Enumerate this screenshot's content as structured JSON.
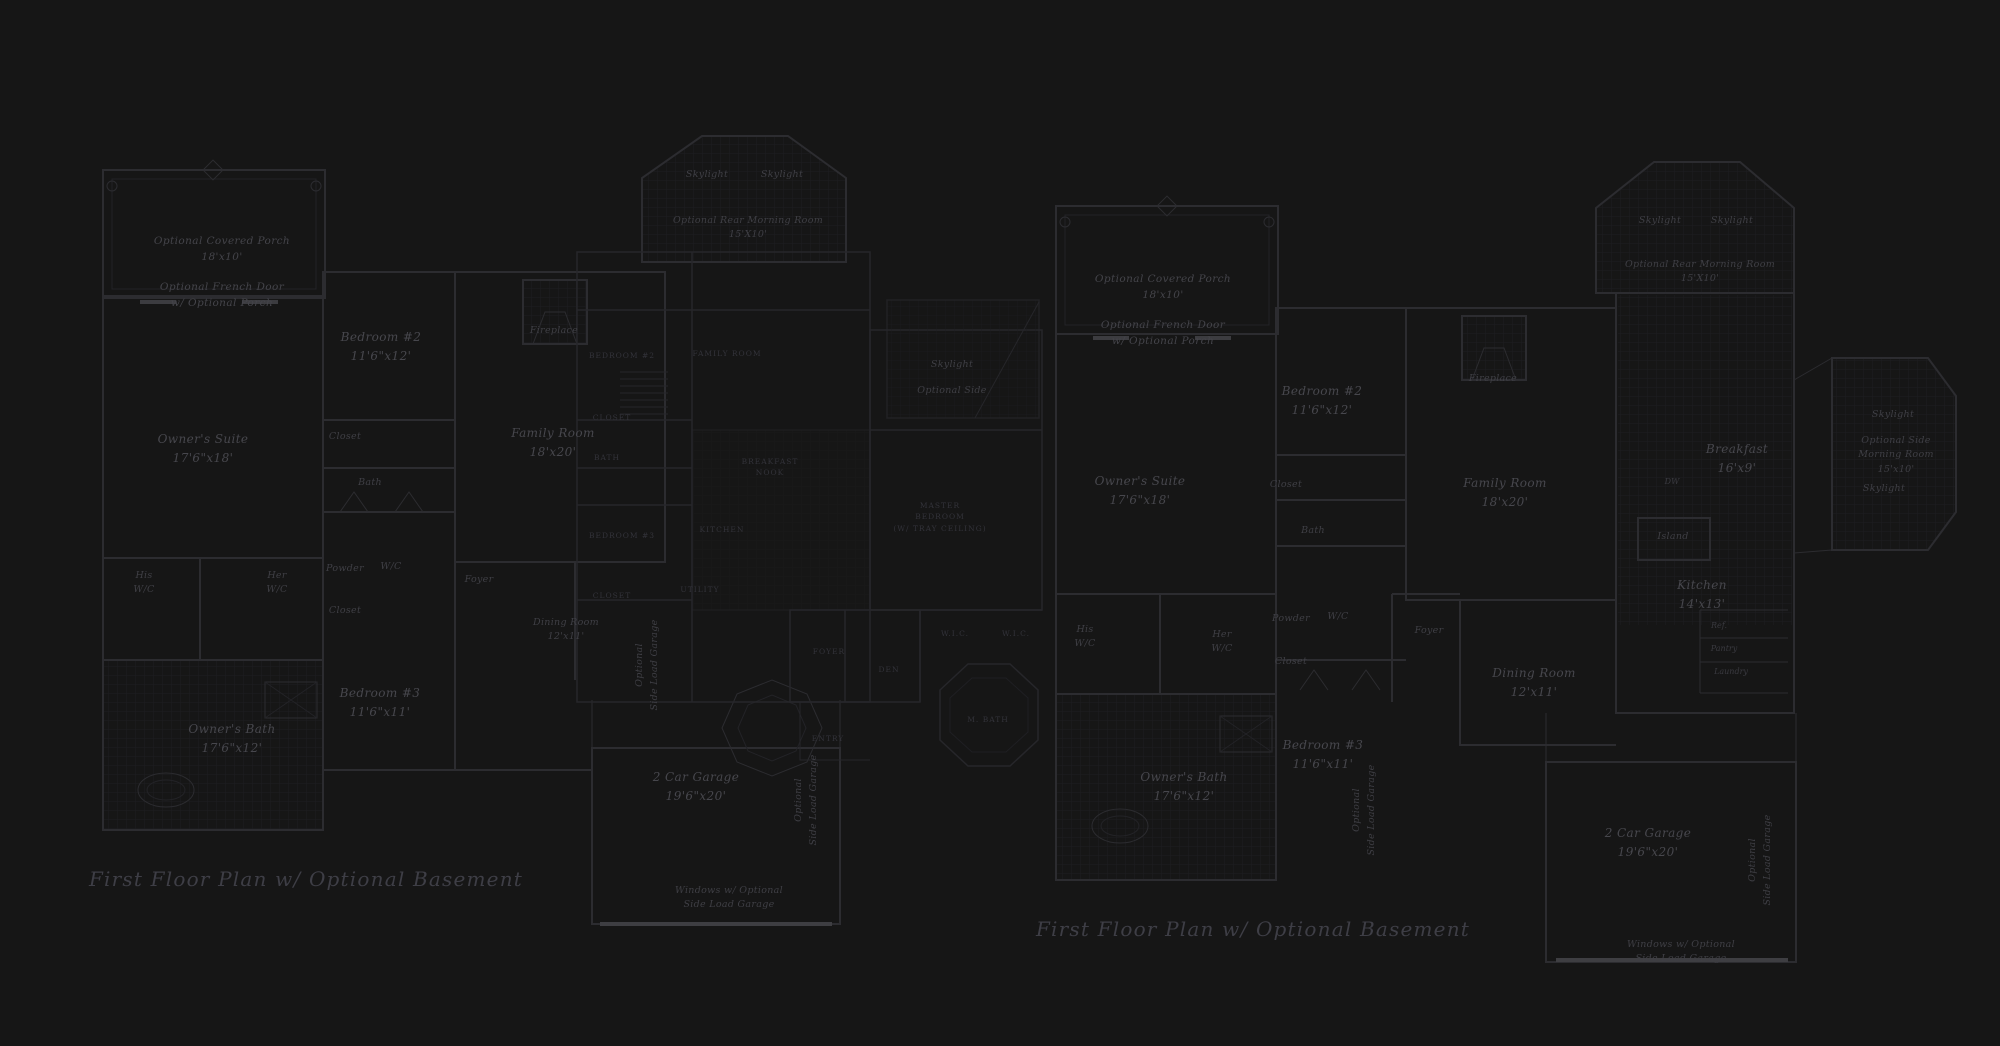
{
  "document": {
    "kind": "architectural floor plan sheet",
    "background": "#161616"
  },
  "colors": {
    "background": "#161616",
    "wall": "#2c2c30",
    "wall_faint": "#26262a",
    "wall_bright": "#3e3e42",
    "tile_grid": "#1e1e21",
    "script_text": "#44444a",
    "caps_text": "#33333a",
    "title_text": "#3e3e46"
  },
  "plan_titles": {
    "left": "First Floor Plan  w/ Optional Basement",
    "right": "First Floor Plan  w/ Optional Basement"
  },
  "labels": [
    {
      "n": "porch-label-left",
      "x": 222,
      "y": 234,
      "c": "s",
      "t": [
        "Optional Covered Porch",
        "18'x10'"
      ]
    },
    {
      "n": "french-door-left",
      "x": 222,
      "y": 280,
      "c": "s",
      "t": [
        "Optional French Door",
        "w/ Optional Porch"
      ]
    },
    {
      "n": "owners-suite-left",
      "x": 203,
      "y": 430,
      "c": "m",
      "t": [
        "Owner's Suite",
        "17'6\"x18'"
      ]
    },
    {
      "n": "bedroom2-left",
      "x": 381,
      "y": 328,
      "c": "m",
      "t": [
        "Bedroom #2",
        "11'6\"x12'"
      ]
    },
    {
      "n": "closet-upper-left",
      "x": 345,
      "y": 430,
      "c": "sm",
      "t": [
        "Closet"
      ]
    },
    {
      "n": "bath-left",
      "x": 370,
      "y": 476,
      "c": "sm",
      "t": [
        "Bath"
      ]
    },
    {
      "n": "fireplace-left",
      "x": 554,
      "y": 324,
      "c": "sm",
      "t": [
        "Fireplace"
      ]
    },
    {
      "n": "family-room-left",
      "x": 553,
      "y": 424,
      "c": "m",
      "t": [
        "Family Room",
        "18'x20'"
      ]
    },
    {
      "n": "skylight-left-a",
      "x": 707,
      "y": 168,
      "c": "sm",
      "t": [
        "Skylight"
      ]
    },
    {
      "n": "skylight-left-b",
      "x": 782,
      "y": 168,
      "c": "sm",
      "t": [
        "Skylight"
      ]
    },
    {
      "n": "rear-morning-room-left",
      "x": 748,
      "y": 214,
      "c": "sm",
      "t": [
        "Optional Rear Morning Room",
        "15'X10'"
      ]
    },
    {
      "n": "foyer-left",
      "x": 479,
      "y": 573,
      "c": "sm",
      "t": [
        "Foyer"
      ]
    },
    {
      "n": "dining-room-left",
      "x": 566,
      "y": 616,
      "c": "sm",
      "t": [
        "Dining Room",
        "12'x11'"
      ]
    },
    {
      "n": "his-wc-left",
      "x": 144,
      "y": 569,
      "c": "sm",
      "t": [
        "His",
        "W/C"
      ]
    },
    {
      "n": "her-wc-left",
      "x": 277,
      "y": 569,
      "c": "sm",
      "t": [
        "Her",
        "W/C"
      ]
    },
    {
      "n": "powder-left",
      "x": 345,
      "y": 562,
      "c": "sm",
      "t": [
        "Powder"
      ]
    },
    {
      "n": "wc-left",
      "x": 391,
      "y": 560,
      "c": "sm",
      "t": [
        "W/C"
      ]
    },
    {
      "n": "closet-lower-left",
      "x": 345,
      "y": 604,
      "c": "sm",
      "t": [
        "Closet"
      ]
    },
    {
      "n": "bedroom3-left",
      "x": 380,
      "y": 684,
      "c": "m",
      "t": [
        "Bedroom #3",
        "11'6\"x11'"
      ]
    },
    {
      "n": "owners-bath-left",
      "x": 232,
      "y": 720,
      "c": "m",
      "t": [
        "Owner's Bath",
        "17'6\"x12'"
      ]
    },
    {
      "n": "garage-left",
      "x": 696,
      "y": 768,
      "c": "m",
      "t": [
        "2 Car Garage",
        "19'6\"x20'"
      ]
    },
    {
      "n": "side-load-vert-left-a",
      "x": 647,
      "y": 665,
      "c": "vert",
      "t": [
        "Optional",
        "Side Load Garage"
      ]
    },
    {
      "n": "side-load-vert-left-b",
      "x": 806,
      "y": 800,
      "c": "vert",
      "t": [
        "Optional",
        "Side Load Garage"
      ]
    },
    {
      "n": "windows-note-left",
      "x": 729,
      "y": 884,
      "c": "sm",
      "t": [
        "Windows w/ Optional",
        "Side Load Garage"
      ]
    },
    {
      "n": "title-left",
      "x": 306,
      "y": 866,
      "c": "title",
      "t": [
        "First Floor Plan  w/ Optional Basement"
      ]
    },
    {
      "n": "mid-bedroom2",
      "x": 622,
      "y": 350,
      "c": "caps",
      "t": [
        "BEDROOM #2"
      ]
    },
    {
      "n": "mid-family-room",
      "x": 727,
      "y": 348,
      "c": "caps",
      "t": [
        "FAMILY ROOM"
      ]
    },
    {
      "n": "mid-closet-a",
      "x": 612,
      "y": 412,
      "c": "caps",
      "t": [
        "CLOSET"
      ]
    },
    {
      "n": "mid-bath",
      "x": 607,
      "y": 452,
      "c": "caps",
      "t": [
        "BATH"
      ]
    },
    {
      "n": "mid-bedroom3",
      "x": 622,
      "y": 530,
      "c": "caps",
      "t": [
        "BEDROOM #3"
      ]
    },
    {
      "n": "mid-breakfast-nook",
      "x": 770,
      "y": 456,
      "c": "caps",
      "t": [
        "BREAKFAST",
        "NOOK"
      ]
    },
    {
      "n": "mid-kitchen",
      "x": 722,
      "y": 524,
      "c": "caps",
      "t": [
        "KITCHEN"
      ]
    },
    {
      "n": "mid-utility",
      "x": 700,
      "y": 584,
      "c": "caps",
      "t": [
        "UTILITY"
      ]
    },
    {
      "n": "mid-closet-b",
      "x": 612,
      "y": 590,
      "c": "caps",
      "t": [
        "CLOSET"
      ]
    },
    {
      "n": "mid-skylight",
      "x": 952,
      "y": 358,
      "c": "sm",
      "t": [
        "Skylight"
      ]
    },
    {
      "n": "mid-optional-side",
      "x": 952,
      "y": 384,
      "c": "sm",
      "t": [
        "Optional Side"
      ]
    },
    {
      "n": "mid-master-bedroom",
      "x": 940,
      "y": 500,
      "c": "caps",
      "t": [
        "MASTER",
        "BEDROOM",
        "(W/ TRAY CEILING)"
      ]
    },
    {
      "n": "mid-wic-a",
      "x": 955,
      "y": 628,
      "c": "caps",
      "t": [
        "W.I.C."
      ]
    },
    {
      "n": "mid-wic-b",
      "x": 1016,
      "y": 628,
      "c": "caps",
      "t": [
        "W.I.C."
      ]
    },
    {
      "n": "mid-mbath",
      "x": 988,
      "y": 714,
      "c": "caps",
      "t": [
        "M. BATH"
      ]
    },
    {
      "n": "mid-foyer",
      "x": 829,
      "y": 646,
      "c": "caps",
      "t": [
        "FOYER"
      ]
    },
    {
      "n": "mid-den",
      "x": 889,
      "y": 664,
      "c": "caps",
      "t": [
        "DEN"
      ]
    },
    {
      "n": "mid-entry",
      "x": 828,
      "y": 733,
      "c": "caps",
      "t": [
        "ENTRY"
      ]
    },
    {
      "n": "porch-label-right",
      "x": 1163,
      "y": 272,
      "c": "s",
      "t": [
        "Optional Covered Porch",
        "18'x10'"
      ]
    },
    {
      "n": "french-door-right",
      "x": 1163,
      "y": 318,
      "c": "s",
      "t": [
        "Optional French Door",
        "w/ Optional Porch"
      ]
    },
    {
      "n": "owners-suite-right",
      "x": 1140,
      "y": 472,
      "c": "m",
      "t": [
        "Owner's Suite",
        "17'6\"x18'"
      ]
    },
    {
      "n": "bedroom2-right",
      "x": 1322,
      "y": 382,
      "c": "m",
      "t": [
        "Bedroom #2",
        "11'6\"x12'"
      ]
    },
    {
      "n": "closet-upper-right",
      "x": 1286,
      "y": 478,
      "c": "sm",
      "t": [
        "Closet"
      ]
    },
    {
      "n": "bath-right",
      "x": 1313,
      "y": 524,
      "c": "sm",
      "t": [
        "Bath"
      ]
    },
    {
      "n": "fireplace-right",
      "x": 1493,
      "y": 372,
      "c": "sm",
      "t": [
        "Fireplace"
      ]
    },
    {
      "n": "family-room-right",
      "x": 1505,
      "y": 474,
      "c": "m",
      "t": [
        "Family Room",
        "18'x20'"
      ]
    },
    {
      "n": "skylight-right-a",
      "x": 1660,
      "y": 214,
      "c": "sm",
      "t": [
        "Skylight"
      ]
    },
    {
      "n": "skylight-right-b",
      "x": 1732,
      "y": 214,
      "c": "sm",
      "t": [
        "Skylight"
      ]
    },
    {
      "n": "rear-morning-room-right",
      "x": 1700,
      "y": 258,
      "c": "sm",
      "t": [
        "Optional Rear Morning Room",
        "15'X10'"
      ]
    },
    {
      "n": "breakfast-right",
      "x": 1737,
      "y": 440,
      "c": "m",
      "t": [
        "Breakfast",
        "16'x9'"
      ]
    },
    {
      "n": "dw-right",
      "x": 1672,
      "y": 476,
      "c": "xs",
      "t": [
        "DW"
      ]
    },
    {
      "n": "island-right",
      "x": 1673,
      "y": 530,
      "c": "sm",
      "t": [
        "Island"
      ]
    },
    {
      "n": "kitchen-right",
      "x": 1702,
      "y": 576,
      "c": "m",
      "t": [
        "Kitchen",
        "14'x13'"
      ]
    },
    {
      "n": "ref-right",
      "x": 1719,
      "y": 620,
      "c": "xs",
      "t": [
        "Ref."
      ]
    },
    {
      "n": "pantry-right",
      "x": 1724,
      "y": 643,
      "c": "xs",
      "t": [
        "Pantry"
      ]
    },
    {
      "n": "laundry-right",
      "x": 1731,
      "y": 666,
      "c": "xs",
      "t": [
        "Laundry"
      ]
    },
    {
      "n": "side-skylight-right-a",
      "x": 1893,
      "y": 408,
      "c": "sm",
      "t": [
        "Skylight"
      ]
    },
    {
      "n": "side-morning-room-right",
      "x": 1896,
      "y": 434,
      "c": "sm",
      "t": [
        "Optional Side",
        "Morning Room",
        "15'x10'"
      ]
    },
    {
      "n": "side-skylight-right-b",
      "x": 1884,
      "y": 482,
      "c": "sm",
      "t": [
        "Skylight"
      ]
    },
    {
      "n": "his-wc-right",
      "x": 1085,
      "y": 623,
      "c": "sm",
      "t": [
        "His",
        "W/C"
      ]
    },
    {
      "n": "her-wc-right",
      "x": 1222,
      "y": 628,
      "c": "sm",
      "t": [
        "Her",
        "W/C"
      ]
    },
    {
      "n": "powder-right",
      "x": 1291,
      "y": 612,
      "c": "sm",
      "t": [
        "Powder"
      ]
    },
    {
      "n": "wc-right",
      "x": 1338,
      "y": 610,
      "c": "sm",
      "t": [
        "W/C"
      ]
    },
    {
      "n": "closet-lower-right",
      "x": 1291,
      "y": 655,
      "c": "sm",
      "t": [
        "Closet"
      ]
    },
    {
      "n": "foyer-right",
      "x": 1429,
      "y": 624,
      "c": "sm",
      "t": [
        "Foyer"
      ]
    },
    {
      "n": "dining-room-right",
      "x": 1534,
      "y": 664,
      "c": "m",
      "t": [
        "Dining Room",
        "12'x11'"
      ]
    },
    {
      "n": "bedroom3-right",
      "x": 1323,
      "y": 736,
      "c": "m",
      "t": [
        "Bedroom #3",
        "11'6\"x11'"
      ]
    },
    {
      "n": "owners-bath-right",
      "x": 1184,
      "y": 768,
      "c": "m",
      "t": [
        "Owner's Bath",
        "17'6\"x12'"
      ]
    },
    {
      "n": "garage-right",
      "x": 1648,
      "y": 824,
      "c": "m",
      "t": [
        "2 Car Garage",
        "19'6\"x20'"
      ]
    },
    {
      "n": "side-load-vert-right-a",
      "x": 1364,
      "y": 810,
      "c": "vert",
      "t": [
        "Optional",
        "Side Load Garage"
      ]
    },
    {
      "n": "side-load-vert-right-b",
      "x": 1760,
      "y": 860,
      "c": "vert",
      "t": [
        "Optional",
        "Side Load Garage"
      ]
    },
    {
      "n": "windows-note-right",
      "x": 1681,
      "y": 938,
      "c": "sm",
      "t": [
        "Windows w/ Optional",
        "Side Load Garage"
      ]
    },
    {
      "n": "title-right",
      "x": 1253,
      "y": 916,
      "c": "title",
      "t": [
        "First Floor Plan  w/ Optional Basement"
      ]
    }
  ]
}
